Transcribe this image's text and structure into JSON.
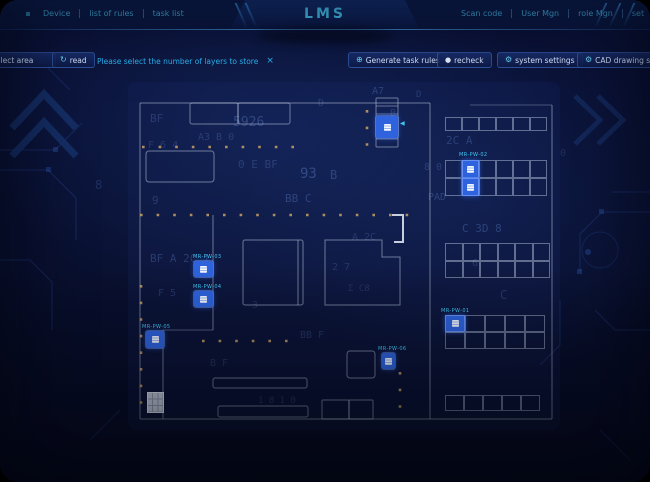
{
  "app": {
    "title": "LMS"
  },
  "header": {
    "left_menu": [
      {
        "label": "Device"
      },
      {
        "label": "list of rules"
      },
      {
        "label": "task list"
      }
    ],
    "right_menu": [
      {
        "label": "Scan code"
      },
      {
        "label": "User Mgn"
      },
      {
        "label": "role Mgn"
      },
      {
        "label": "set"
      }
    ]
  },
  "toolbar": {
    "select_area_label": "select area",
    "read_label": "read",
    "read_icon": "↻",
    "message": "Please select the number of layers to store",
    "close_label": "×",
    "generate_label": "Generate task rules",
    "generate_icon": "⊕",
    "recheck_label": "recheck",
    "recheck_icon": "●",
    "system_settings_label": "system settings",
    "system_settings_icon": "⚙",
    "cad_settings_label": "CAD drawing settings",
    "cad_settings_icon": "⚙"
  },
  "colors": {
    "accent": "#46c7f5",
    "marker_blue": "#2e63dd",
    "label_cyan": "#41c8f4",
    "dot_tan": "#c9a265",
    "wall": "#c9d6ea"
  },
  "map": {
    "markers": [
      {
        "id": "rack-station",
        "label": "",
        "x": 376,
        "y": 116,
        "w": 22,
        "h": 22,
        "arrow_x": 400,
        "arrow_y": 120
      },
      {
        "id": "device-pw-03",
        "label": "MR-PW-03",
        "x": 194,
        "y": 261,
        "w": 19,
        "h": 16,
        "lx": 193,
        "ly": 254
      },
      {
        "id": "device-pw-04",
        "label": "MR-PW-04",
        "x": 194,
        "y": 291,
        "w": 19,
        "h": 16,
        "lx": 193,
        "ly": 284
      },
      {
        "id": "device-pw-05",
        "label": "MR-PW-05",
        "x": 146,
        "y": 331,
        "w": 18,
        "h": 17,
        "lx": 142,
        "ly": 324
      },
      {
        "id": "device-pw-06",
        "label": "MR-PW-06",
        "x": 382,
        "y": 353,
        "w": 13,
        "h": 16,
        "lx": 378,
        "ly": 346
      }
    ],
    "racks": [
      {
        "id": "rack-a",
        "x": 445,
        "y": 117,
        "cols": 6,
        "rows": 1,
        "cw": 17,
        "ch": 14,
        "hl": []
      },
      {
        "id": "rack-b",
        "x": 445,
        "y": 160,
        "cols": 6,
        "rows": 2,
        "cw": 17,
        "ch": 18,
        "label": "MR-PW-02",
        "lx": 459,
        "ly": 152,
        "hl": [
          [
            0,
            1
          ],
          [
            1,
            1
          ]
        ]
      },
      {
        "id": "rack-c",
        "x": 445,
        "y": 243,
        "cols": 6,
        "rows": 2,
        "cw": 17.5,
        "ch": 17.5,
        "hl": []
      },
      {
        "id": "rack-d",
        "x": 445,
        "y": 315,
        "cols": 5,
        "rows": 2,
        "cw": 20,
        "ch": 17,
        "label": "MR-PW-01",
        "lx": 441,
        "ly": 308,
        "hl": [
          [
            0,
            0
          ]
        ]
      },
      {
        "id": "rack-e",
        "x": 445,
        "y": 395,
        "cols": 5,
        "rows": 1,
        "cw": 19,
        "ch": 16,
        "hl": []
      }
    ],
    "backdrop_glyphs": [
      {
        "t": "BF",
        "x": 150,
        "y": 112,
        "s": 11,
        "o": 0.25
      },
      {
        "t": "5926",
        "x": 233,
        "y": 115,
        "s": 13,
        "o": 0.32
      },
      {
        "t": "D",
        "x": 318,
        "y": 98,
        "s": 10,
        "o": 0.25
      },
      {
        "t": "A7",
        "x": 372,
        "y": 86,
        "s": 10,
        "o": 0.3
      },
      {
        "t": "D",
        "x": 416,
        "y": 90,
        "s": 9,
        "o": 0.25
      },
      {
        "t": "A3 B 0",
        "x": 198,
        "y": 132,
        "s": 10,
        "o": 0.25
      },
      {
        "t": "0  E  BF",
        "x": 238,
        "y": 158,
        "s": 11,
        "o": 0.25
      },
      {
        "t": "93",
        "x": 300,
        "y": 166,
        "s": 14,
        "o": 0.35
      },
      {
        "t": "B",
        "x": 330,
        "y": 168,
        "s": 12,
        "o": 0.3
      },
      {
        "t": "9",
        "x": 152,
        "y": 194,
        "s": 11,
        "o": 0.25
      },
      {
        "t": "BB  C",
        "x": 285,
        "y": 192,
        "s": 11,
        "o": 0.3
      },
      {
        "t": "BF  A  2C  1",
        "x": 150,
        "y": 252,
        "s": 11,
        "o": 0.28
      },
      {
        "t": "F  5",
        "x": 158,
        "y": 288,
        "s": 10,
        "o": 0.24
      },
      {
        "t": "3",
        "x": 252,
        "y": 300,
        "s": 10,
        "o": 0.2
      },
      {
        "t": "BB  F",
        "x": 300,
        "y": 330,
        "s": 10,
        "o": 0.24
      },
      {
        "t": "PAD",
        "x": 428,
        "y": 192,
        "s": 10,
        "o": 0.3
      },
      {
        "t": "8 0",
        "x": 424,
        "y": 162,
        "s": 10,
        "o": 0.25
      },
      {
        "t": "2C  A",
        "x": 446,
        "y": 134,
        "s": 11,
        "o": 0.28
      },
      {
        "t": "C  3D  8",
        "x": 462,
        "y": 222,
        "s": 11,
        "o": 0.3
      },
      {
        "t": "6",
        "x": 472,
        "y": 258,
        "s": 10,
        "o": 0.25
      },
      {
        "t": "C",
        "x": 500,
        "y": 288,
        "s": 12,
        "o": 0.25
      },
      {
        "t": "B  F",
        "x": 210,
        "y": 358,
        "s": 10,
        "o": 0.22
      },
      {
        "t": "1 8 1 0",
        "x": 258,
        "y": 396,
        "s": 9,
        "o": 0.22
      },
      {
        "t": "2  7",
        "x": 332,
        "y": 262,
        "s": 10,
        "o": 0.22
      },
      {
        "t": "Σ  C8",
        "x": 348,
        "y": 284,
        "s": 9,
        "o": 0.2
      },
      {
        "t": "B",
        "x": 390,
        "y": 108,
        "s": 10,
        "o": 0.25
      },
      {
        "t": "8",
        "x": 95,
        "y": 178,
        "s": 12,
        "o": 0.2
      },
      {
        "t": "0",
        "x": 560,
        "y": 148,
        "s": 10,
        "o": 0.2
      },
      {
        "t": "F 6 4",
        "x": 148,
        "y": 140,
        "s": 10,
        "o": 0.22
      },
      {
        "t": "A 2C",
        "x": 352,
        "y": 232,
        "s": 10,
        "o": 0.22
      }
    ]
  }
}
